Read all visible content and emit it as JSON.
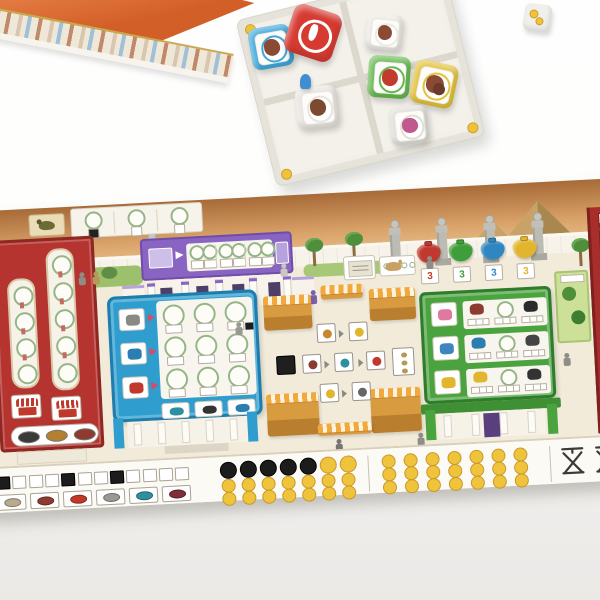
{
  "scene": {
    "background_top": "#fefefe",
    "background_bottom": "#eae9e6"
  },
  "game_box": {
    "roof_color": "#d35f28",
    "roof_highlight": "#ea8a4f",
    "wall_color": "#efe8d8",
    "trim_color": "#caa84e"
  },
  "dice_tray": {
    "surface_color": "#f3f1ea",
    "wall_color": "#e6e3da",
    "divider_color": "#dcd8cd",
    "quadrants": 4,
    "corner_coins": 4,
    "corner_coin_color": "#eec339"
  },
  "dice": [
    {
      "id": "blue-die",
      "color": "#3fa8da",
      "sticker_icon": "brown-animal",
      "sticker_color": "#8a4a33"
    },
    {
      "id": "red-die",
      "color": "#d63a31",
      "sticker_icon": "amphora",
      "sticker_color": "#ffffff"
    },
    {
      "id": "white-die-top",
      "color": "#eceae3",
      "sticker_icon": "brown-animal",
      "sticker_color": "#8a4a33"
    },
    {
      "id": "white-die-mid",
      "color": "#e7e5de",
      "sticker_icon": "brown-animal",
      "sticker_color": "#7c4a2e"
    },
    {
      "id": "green-die",
      "color": "#66b94f",
      "sticker_icon": "red-produce",
      "sticker_color": "#c23c2e"
    },
    {
      "id": "yellow-die",
      "color": "#e2c239",
      "sticker_icon": "brown-goods-pair",
      "sticker_color": "#8a4a33"
    },
    {
      "id": "gray-die",
      "color": "#e0ded7",
      "sticker_icon": "pink-goods",
      "sticker_color": "#c05a8e"
    }
  ],
  "blue_pawn_color": "#3f8fd0",
  "loose_die": {
    "color": "#f0efeb",
    "sticker_icon": "gold-coins",
    "sticker_color": "#eec339"
  },
  "board": {
    "base_color": "#f2ebda",
    "sky_colors": [
      "#a76a38",
      "#d9a268",
      "#ecc89a"
    ],
    "wall_color": "#f7f3ea",
    "pyramids": {
      "count": 2,
      "color": "#c8a266",
      "shadow": "#ab8750"
    },
    "statues": {
      "count": 5,
      "color": "#bcbcb4"
    },
    "palm_trees": 3,
    "goat_tile": {
      "icon": "goat",
      "tile_color": "#e9dcb6"
    },
    "goat_track": {
      "groups": 3,
      "filled_first_square": true
    },
    "purple_temple": {
      "frieze_color": "#8a64c2",
      "accent": "#b7a2dd",
      "score_groups": 3,
      "circles_per_group": 2,
      "doorways": 4,
      "columns": 5
    },
    "blue_palace": {
      "panel_color": "#2f9ecf",
      "border": "#1e7dad",
      "grid_rows": 3,
      "grid_cols": 3,
      "row_icon_colors": [
        "#8a8a85",
        "#2b7fb0",
        "#c0392b"
      ],
      "bottom_icon_colors": [
        "#2e8f9e",
        "#333333",
        "#2b7fb0"
      ],
      "arrow_color": "#d84a6a"
    },
    "green_palace": {
      "panel_color": "#4aa33f",
      "border": "#2f7d2c",
      "rows": 3,
      "row_icon_colors": [
        "#e078a0",
        "#3f86c0",
        "#e2b52e"
      ],
      "item_colors": [
        [
          "#8e3b2f",
          "wreath",
          "#2b2b2b"
        ],
        [
          "#2b7fb0",
          "wreath",
          "#444444"
        ],
        [
          "#e2b52e",
          "wreath",
          "#333333"
        ]
      ],
      "door_color": "#5a3f7e"
    },
    "red_building_left": {
      "color": "#b5342f",
      "border": "#8f2723",
      "track_circles": [
        4,
        5
      ],
      "oval_colors": [
        "#3a3a3a",
        "#b4802f",
        "#8e3b2f"
      ]
    },
    "red_building_right": {
      "color": "#a72e2a"
    },
    "price_bags": [
      {
        "color": "#c0392e",
        "value": "3"
      },
      {
        "color": "#3f9e3a",
        "value": "3"
      },
      {
        "color": "#2f86c0",
        "value": "3"
      },
      {
        "color": "#e2b52e",
        "value": "3"
      }
    ],
    "market": {
      "stalls": 6,
      "awning_color": "#f2a93b",
      "awning_stripe": "#fdf3e2",
      "cell_count": 7,
      "black_cell": true,
      "cell_icon_colors": [
        "#c9862e",
        "#e2b52e",
        "#8e3b2f",
        "#2e8f9e",
        "#c0392b",
        "#e2b52e",
        "#666666"
      ]
    },
    "garden_tile": {
      "color": "#cde098",
      "trees": 2
    },
    "wreath_color": "#96b586"
  },
  "score_strip": {
    "background": "#fcfaf4",
    "turn_track": {
      "cells": 12,
      "filled_indices": [
        0,
        4,
        7
      ]
    },
    "goods_tile_colors": [
      "#b9a98e",
      "#8e3b2f",
      "#c0392b",
      "#9a9a94",
      "#2e8f9e",
      "#7e2f3a"
    ],
    "token_grid": {
      "cols": 7,
      "rows": 3,
      "black_in_first_row": 5,
      "coin_color": "#f0c33c",
      "coin_edge": "#c8992a",
      "black_color": "#1c1c1c"
    },
    "coin_grid": {
      "cols": 7,
      "rows": 3
    },
    "scales": {
      "count": 2,
      "color": "#3a3a3a"
    }
  }
}
